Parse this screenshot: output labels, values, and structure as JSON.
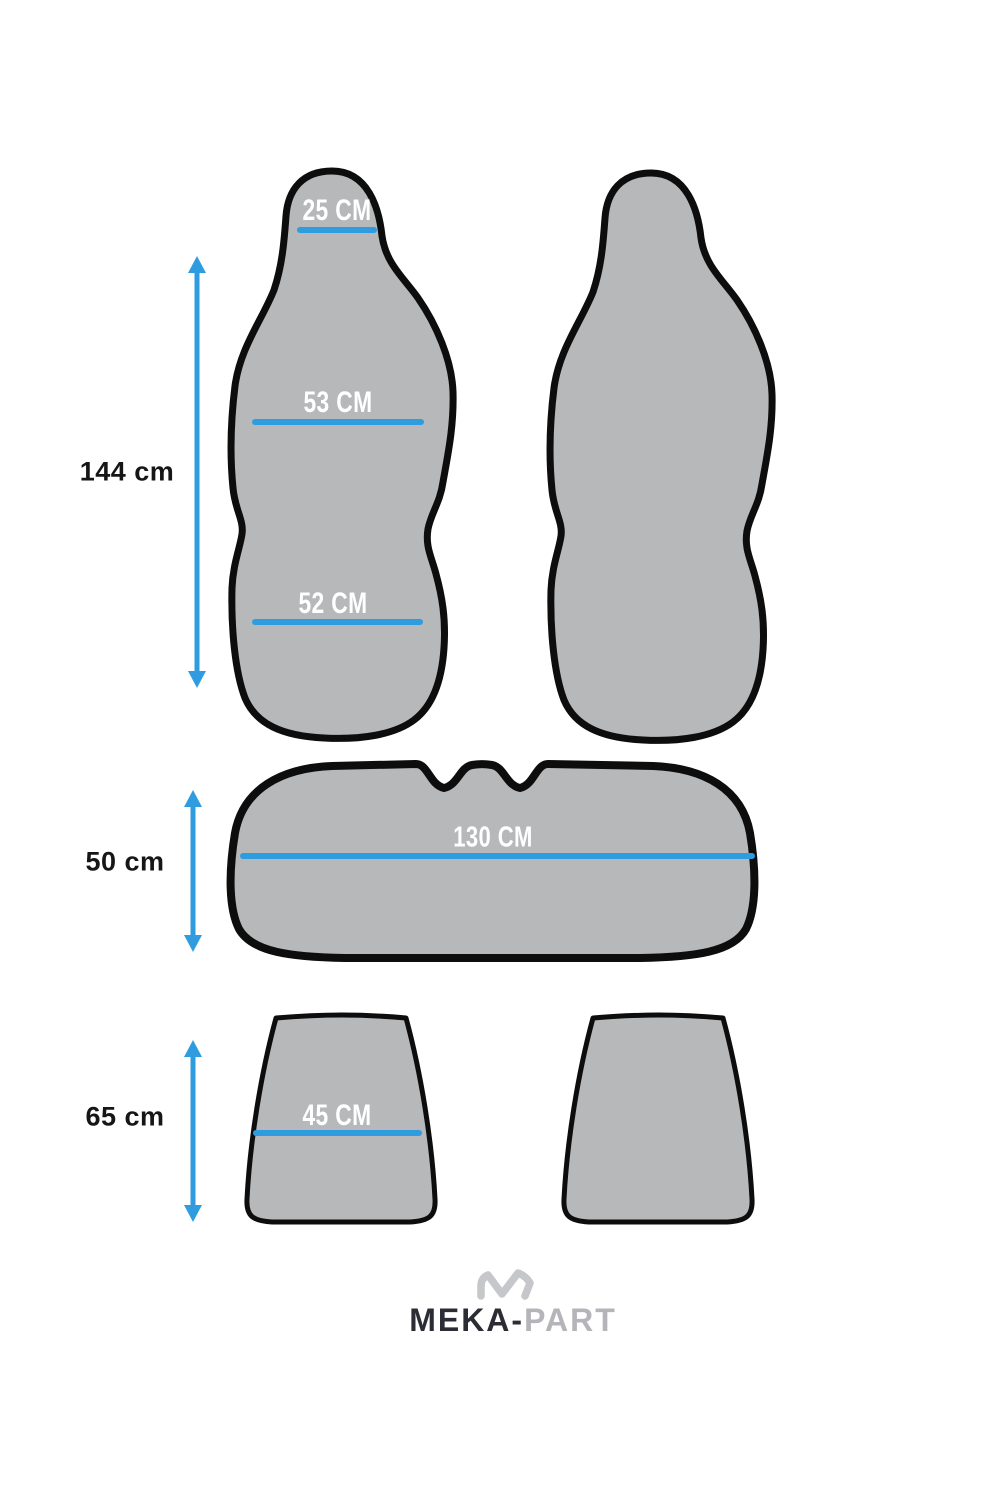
{
  "colors": {
    "background": "#ffffff",
    "shape_fill": "#b6b8ba",
    "shape_outline": "#0d0d0d",
    "accent_blue": "#2f9ce0",
    "label_color": "#161616",
    "logo_dark": "#2c2c34",
    "logo_gray": "#b4b4b9"
  },
  "front_seats": {
    "height_label": "144 cm",
    "headrest_width_label": "25 CM",
    "backrest_width_label": "53 CM",
    "cushion_width_label": "52 CM"
  },
  "bench_seat": {
    "height_label": "50 cm",
    "width_label": "130 CM"
  },
  "rear_backrests": {
    "height_label": "65 cm",
    "width_label": "45 CM"
  },
  "logo": {
    "brand_primary": "MEKA-",
    "brand_secondary": "PART",
    "mark_icon": "mountain-zigzag-icon"
  },
  "icons": {
    "vertical_arrow": "double-headed-arrow-icon"
  }
}
